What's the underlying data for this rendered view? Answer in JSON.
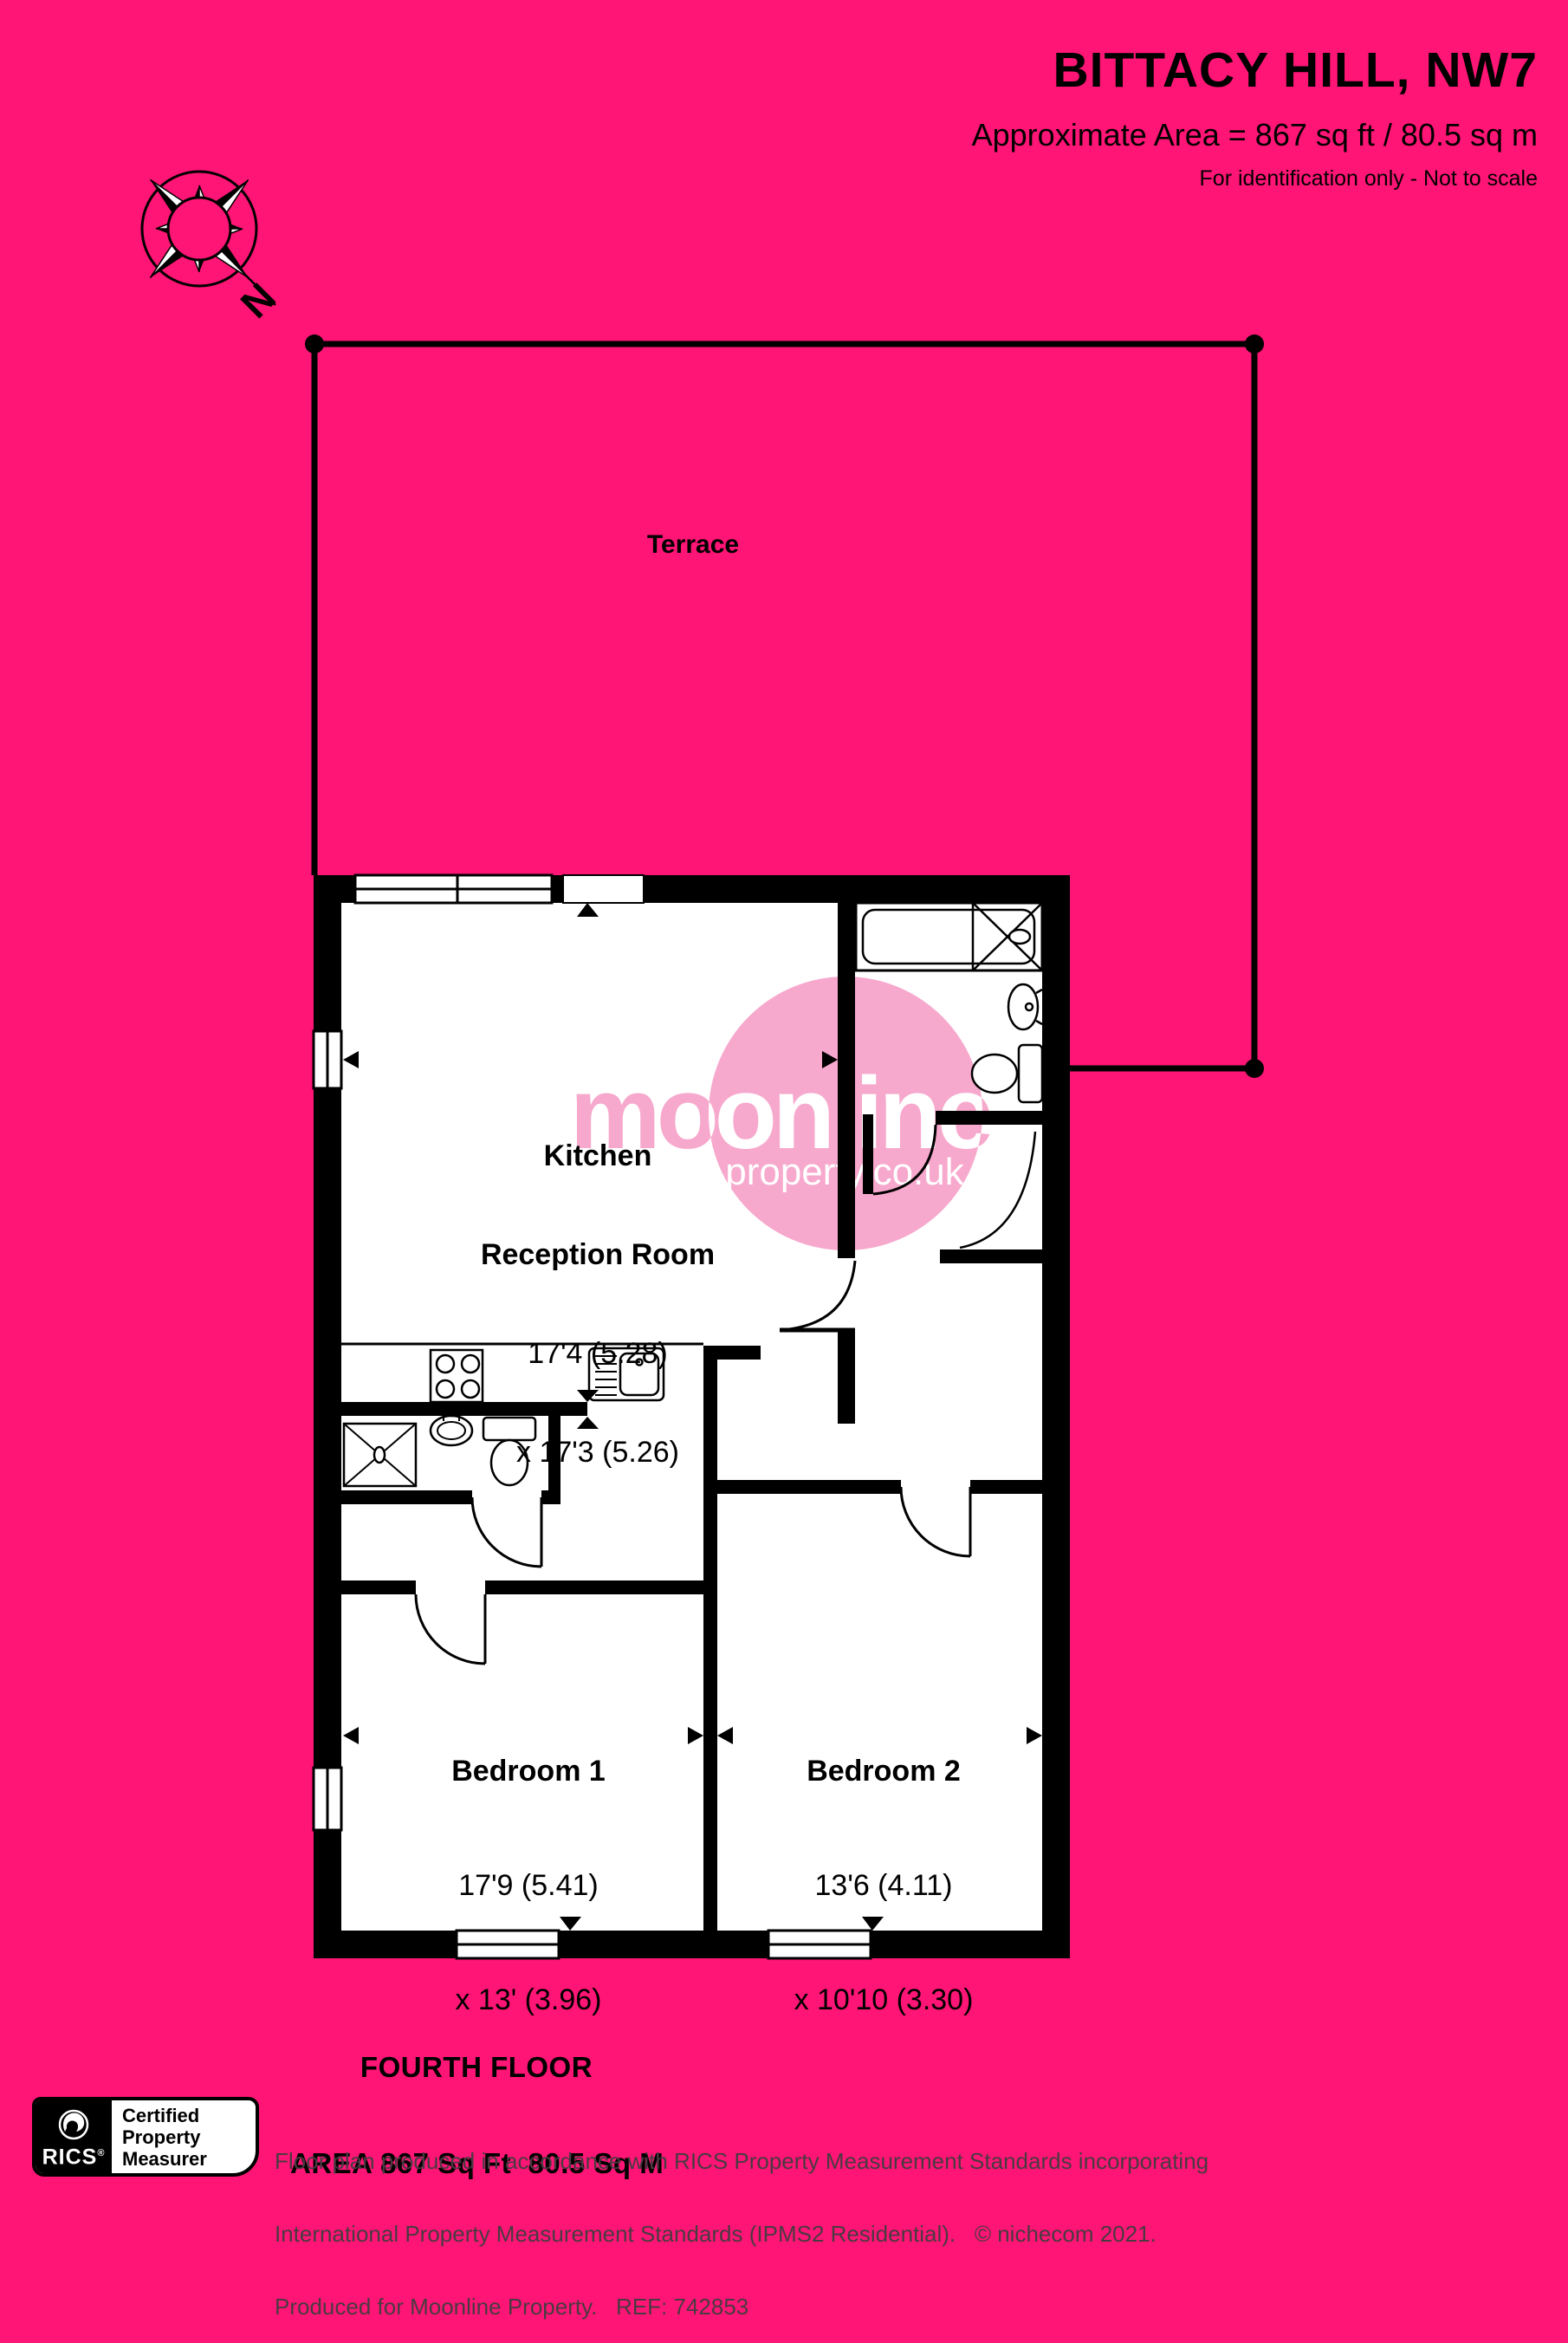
{
  "header": {
    "title": "BITTACY HILL, NW7",
    "subtitle": "Approximate Area = 867 sq ft / 80.5 sq m",
    "note": "For identification only - Not to scale"
  },
  "compass": {
    "north": "N"
  },
  "plan": {
    "terrace_label": "Terrace",
    "kitchen": {
      "line1": "Kitchen",
      "line2": "Reception Room",
      "dim1": "17'4 (5.28)",
      "dim2": "x 17'3 (5.26)"
    },
    "bedroom1": {
      "name": "Bedroom 1",
      "dim1": "17'9 (5.41)",
      "dim2": "x 13' (3.96)"
    },
    "bedroom2": {
      "name": "Bedroom 2",
      "dim1": "13'6 (4.11)",
      "dim2": "x 10'10 (3.30)"
    }
  },
  "floor_label": {
    "line1": "FOURTH FLOOR",
    "line2": "AREA 867 Sq Ft  80.5 Sq M"
  },
  "watermark": {
    "brand": "moonline",
    "domain": "property.co.uk"
  },
  "rics_badge": {
    "org": "RICS",
    "reg": "®",
    "line1": "Certified",
    "line2": "Property",
    "line3": "Measurer"
  },
  "footer": {
    "line1": "Floor plan produced in accordance with RICS Property Measurement Standards incorporating",
    "line2": "International Property Measurement Standards (IPMS2 Residential).   © nichecom 2021.",
    "line3": "Produced for Moonline Property.   REF: 742853"
  },
  "colors": {
    "background": "#ff1575",
    "ink": "#000000",
    "watermark_pink": "#f7a8cd",
    "floor_white": "#ffffff"
  }
}
